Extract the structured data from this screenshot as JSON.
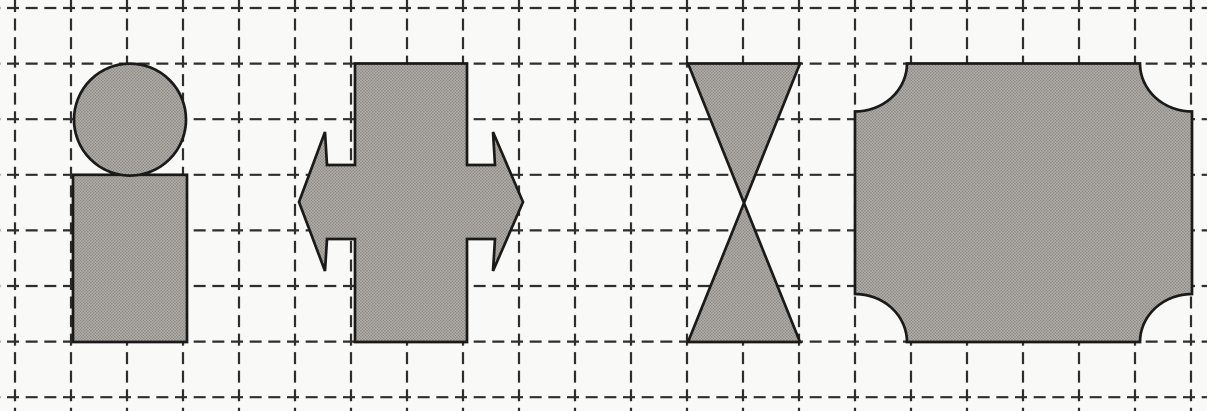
{
  "figure": {
    "description": "Scanned worksheet figure: dashed square grid with four gray symmetric shapes",
    "canvas": {
      "width": 1207,
      "height": 411
    },
    "background_color": "#f9f9f7",
    "grid": {
      "line_color": "#2e2e2e",
      "line_width": 2.2,
      "dash_length": 12,
      "x_origin": 15,
      "y_origin": 8,
      "cell_width": 56,
      "cell_height": 55.6,
      "vertical_lines": 22,
      "horizontal_lines": 8
    },
    "shape_style": {
      "fill_base": "#b0ada8",
      "fill_dot": "#827f7a",
      "outline_color": "#1a1a1a",
      "outline_width": 2.7
    },
    "shapes": [
      {
        "id": "circle-on-rectangle-shape",
        "label": "circle (2-cell diameter) stacked on a 2x3-cell rectangle",
        "elements": [
          {
            "type": "rect",
            "x": 73,
            "y": 174.8,
            "width": 114,
            "height": 167.2
          },
          {
            "type": "circle",
            "cx": 130,
            "cy": 119.6,
            "r": 56
          }
        ]
      },
      {
        "id": "bar-with-double-arrow-shape",
        "label": "vertical 2x5-cell bar merged with a horizontal two-headed arrow",
        "elements": [
          {
            "type": "polygon",
            "points": "355,63.5 467,63.5 467,165 495,165 493,132 523,202 493,271 495,239 467,239 467,342 355,342 355,239 327,239 325,271 299,202 325,132 327,165 355,165"
          }
        ]
      },
      {
        "id": "hourglass-shape",
        "label": "two 2-cell-wide triangles meeting at a center point",
        "elements": [
          {
            "type": "polygon",
            "points": "688,63.5 800,63.5 744,203"
          },
          {
            "type": "polygon",
            "points": "744,203 688,342 800,342"
          }
        ]
      },
      {
        "id": "concave-corner-rectangle-shape",
        "label": "6x5-cell rectangle with concave quarter-circle corners",
        "elements": [
          {
            "type": "path",
            "d": "M 907 63.5 L 1140 63.5 A 52 48 0 0 0 1192 111.5 L 1192 294 A 52 48 0 0 0 1140 342 L 907 342 A 52 48 0 0 0 855 294 L 855 111.5 A 52 48 0 0 0 907 63.5 Z"
          }
        ]
      }
    ]
  }
}
